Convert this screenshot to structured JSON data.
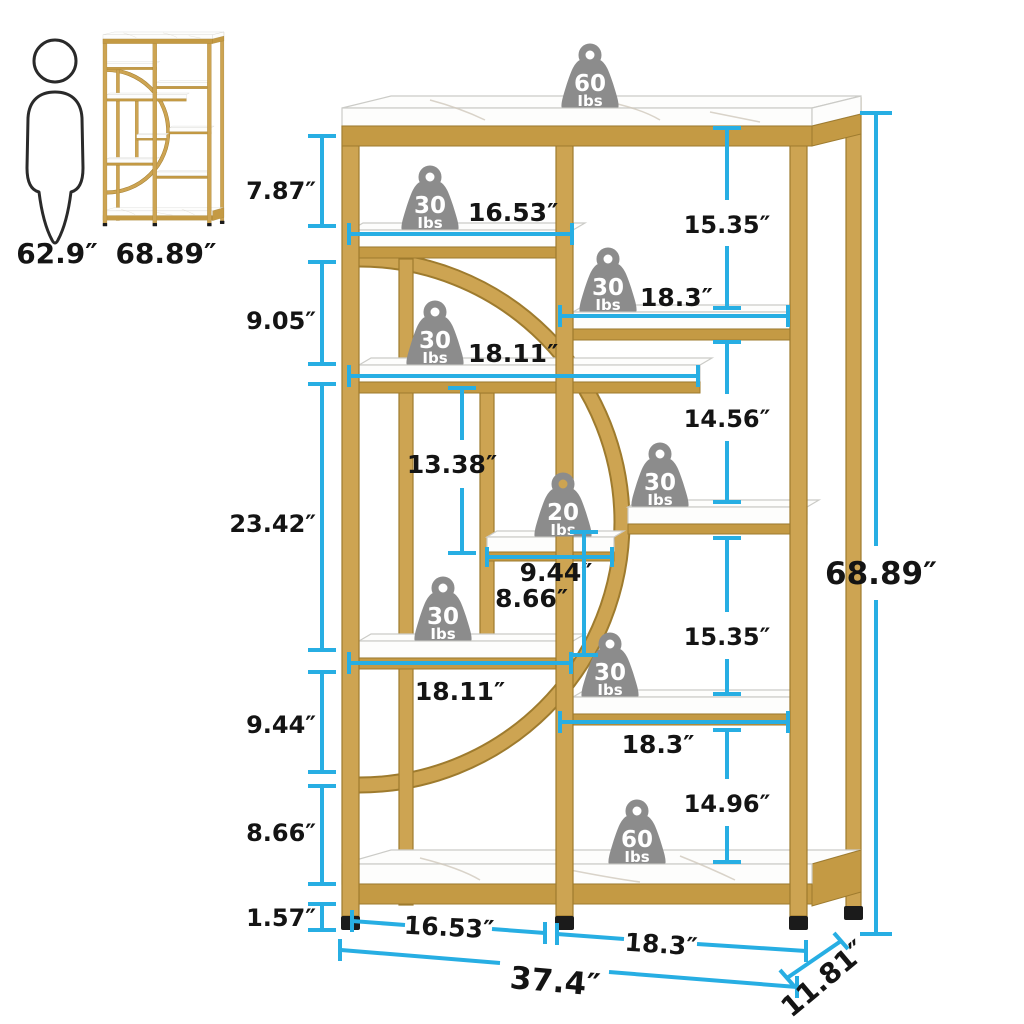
{
  "colors": {
    "accent_cyan": "#27AEE3",
    "frame_gold": "#CDA452",
    "badge_gray": "#8C8C8C",
    "marble_white": "#FDFDFC",
    "text_black": "#141414"
  },
  "scale_reference": {
    "person_height": "62.9″",
    "thumbnail_height": "68.89″"
  },
  "badges": [
    {
      "value": "60",
      "unit": "Ibs",
      "location": "top-shelf"
    },
    {
      "value": "30",
      "unit": "Ibs",
      "location": "upper-left-shelf"
    },
    {
      "value": "30",
      "unit": "Ibs",
      "location": "upper-right-shelf"
    },
    {
      "value": "30",
      "unit": "Ibs",
      "location": "mid-left-shelf"
    },
    {
      "value": "20",
      "unit": "Ibs",
      "location": "center-small-shelf"
    },
    {
      "value": "30",
      "unit": "Ibs",
      "location": "mid-right-shelf"
    },
    {
      "value": "30",
      "unit": "Ibs",
      "location": "lower-left-shelf"
    },
    {
      "value": "30",
      "unit": "Ibs",
      "location": "lower-right-shelf"
    },
    {
      "value": "60",
      "unit": "Ibs",
      "location": "bottom-shelf"
    }
  ],
  "dimensions": {
    "left_stack": [
      "7.87″",
      "9.05″",
      "23.42″",
      "9.44″",
      "8.66″",
      "1.57″"
    ],
    "right_stack": [
      "15.35″",
      "14.56″",
      "15.35″",
      "14.96″"
    ],
    "widths": {
      "upper_left": "16.53″",
      "upper_right": "18.3″",
      "mid_left": "18.11″",
      "center_small": "9.44″",
      "lower_left": "18.11″",
      "lower_right": "18.3″",
      "bottom_left": "16.53″",
      "bottom_right": "18.3″"
    },
    "inner_heights": {
      "upper": "13.38″",
      "lower": "8.66″"
    },
    "overall": {
      "height": "68.89″",
      "width": "37.4″",
      "depth": "11.81″"
    }
  }
}
